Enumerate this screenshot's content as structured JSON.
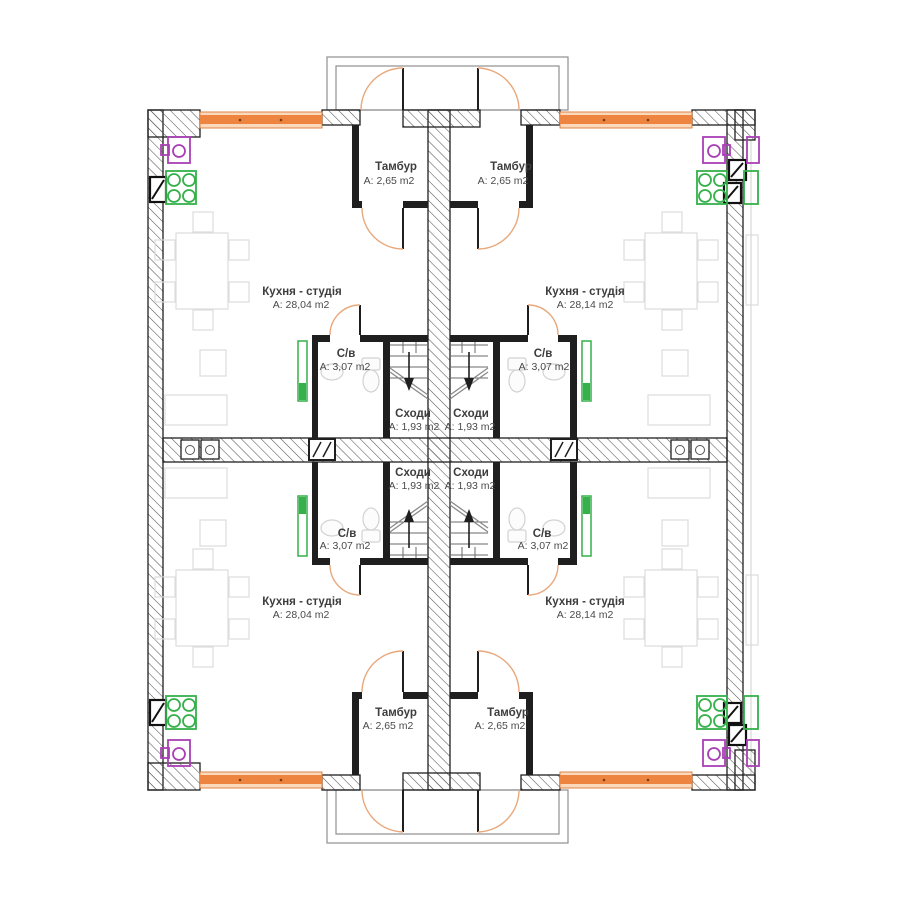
{
  "plan": {
    "units": {
      "top_left": {
        "tambur": {
          "label": "Тамбур",
          "area": "А: 2,65 m2"
        },
        "kitchen": {
          "label": "Кухня - студія",
          "area": "А: 28,04 m2"
        },
        "bath": {
          "label": "С/в",
          "area": "А: 3,07 m2"
        },
        "stairs": {
          "label": "Сходи",
          "area": "А: 1,93 m2"
        }
      },
      "top_right": {
        "tambur": {
          "label": "Тамбур",
          "area": "А: 2,65 m2"
        },
        "kitchen": {
          "label": "Кухня - студія",
          "area": "А: 28,14 m2"
        },
        "bath": {
          "label": "С/в",
          "area": "А: 3,07 m2"
        },
        "stairs": {
          "label": "Сходи",
          "area": "А: 1,93 m2"
        }
      },
      "bottom_left": {
        "tambur": {
          "label": "Тамбур",
          "area": "А: 2,65 m2"
        },
        "kitchen": {
          "label": "Кухня - студія",
          "area": "А: 28,04 m2"
        },
        "bath": {
          "label": "С/в",
          "area": "А: 3,07 m2"
        },
        "stairs": {
          "label": "Сходи",
          "area": "А: 1,93 m2"
        }
      },
      "bottom_right": {
        "tambur": {
          "label": "Тамбур",
          "area": "А: 2,65 m2"
        },
        "kitchen": {
          "label": "Кухня - студія",
          "area": "А: 28,14 m2"
        },
        "bath": {
          "label": "С/в",
          "area": "А: 3,07 m2"
        },
        "stairs": {
          "label": "Сходи",
          "area": "А: 1,93 m2"
        }
      }
    },
    "colors": {
      "wall_line": "#1F1F1F",
      "window_band": "#ED8540",
      "window_band_light": "#FBD9BD",
      "door_arc": "#E8A87C",
      "radiator_green": "#35B04A",
      "sink_purple": "#A93FB5",
      "furniture_gray": "#DCDCDC"
    }
  }
}
